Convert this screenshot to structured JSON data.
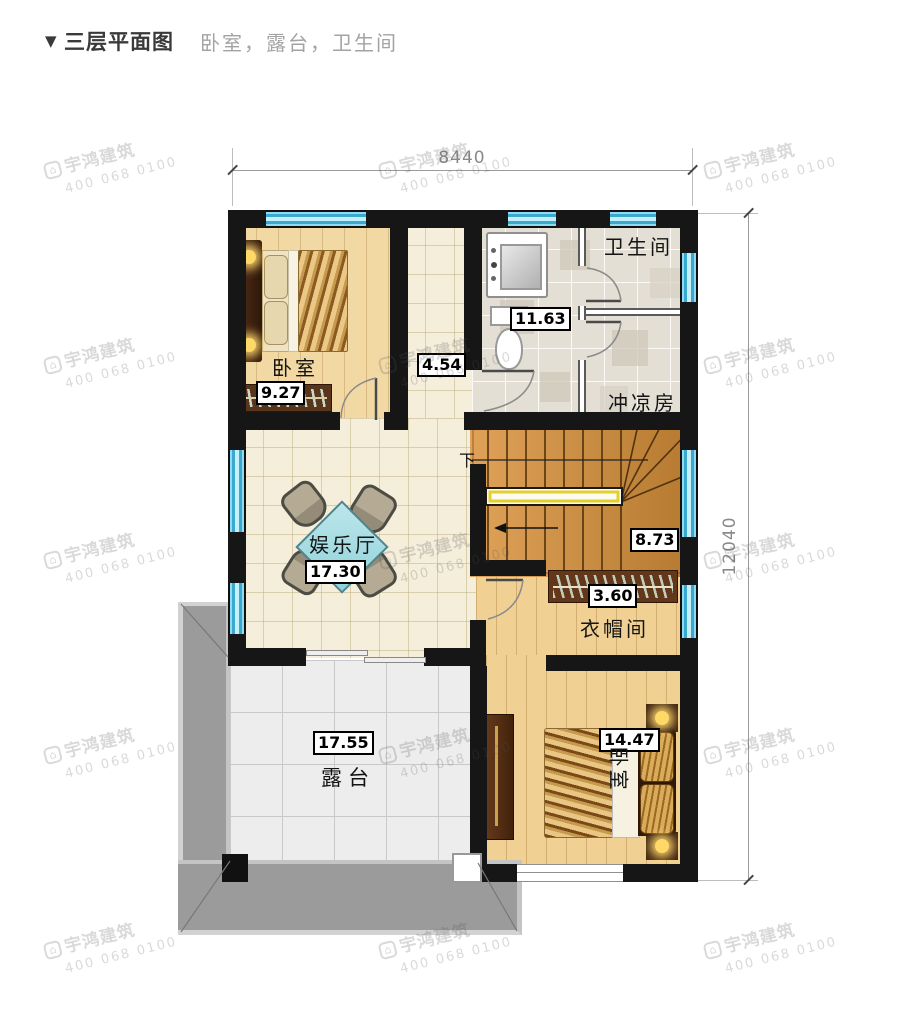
{
  "header": {
    "marker": "▼",
    "title": "三层平面图",
    "subtitle": "卧室，露台，卫生间"
  },
  "dimensions": {
    "top": "8440",
    "right": "12040"
  },
  "rooms": {
    "bedroom1": {
      "name": "卧室",
      "area": "9.27"
    },
    "corridor": {
      "area": "4.54"
    },
    "bath": {
      "area": "11.63"
    },
    "toilet": {
      "name": "卫生间"
    },
    "shower": {
      "name": "冲凉房"
    },
    "stairs": {
      "area": "8.73",
      "down": "下"
    },
    "hall": {
      "name": "娱乐厅",
      "area": "17.30"
    },
    "cloak": {
      "name": "衣帽间",
      "area": "3.60"
    },
    "terrace": {
      "name": "露台",
      "area": "17.55"
    },
    "bedroom2": {
      "name": "卧室",
      "area": "14.47"
    }
  },
  "watermark": {
    "logo": "⌂",
    "brand": "宇鸿建筑",
    "phone": "400 068 0100"
  },
  "colors": {
    "wall": "#161616",
    "window_blue": "#63c6e8",
    "wood_floor": "#f2d9a4",
    "cream_tile": "#f4eedb",
    "bath_tile": "#e4dfd4",
    "terrace_tile": "#ededed",
    "parapet": "#9b9b9b",
    "stair_wood": "#d1914a",
    "table_cyan": "#a9dde4",
    "railing_yellow": "#e3cf2e"
  }
}
